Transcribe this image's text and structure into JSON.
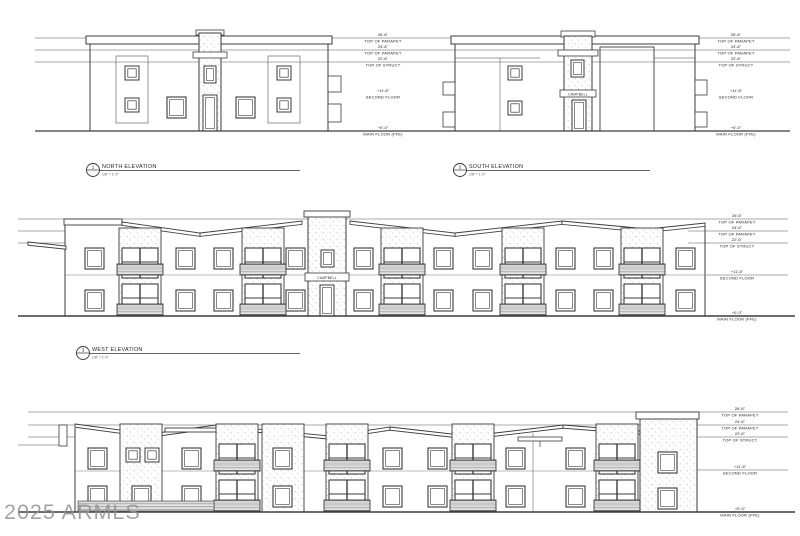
{
  "watermark": {
    "text": "2025 ARMLS"
  },
  "sign": {
    "text": "CAMPBELL"
  },
  "levels": {
    "p26": {
      "value": "26'-6\"",
      "label": "TOP OF PARAPET"
    },
    "p24": {
      "value": "24'-6\"",
      "label": "TOP OF PARAPET"
    },
    "struct": {
      "value": "22'-6\"",
      "label": "TOP OF STRUCT"
    },
    "second": {
      "value": "+11'-6\"",
      "label": "SECOND FLOOR"
    },
    "main": {
      "value": "+0'-0\"",
      "label": "MAIN FLOOR (FFE)"
    }
  },
  "elevations": {
    "north": {
      "number": "1",
      "title": "NORTH ELEVATION",
      "scale": "1/8\" = 1'-0\""
    },
    "south": {
      "number": "2",
      "title": "SOUTH ELEVATION",
      "scale": "1/8\" = 1'-0\""
    },
    "west": {
      "number": "3",
      "title": "WEST ELEVATION",
      "scale": "1/8\" = 1'-0\""
    }
  },
  "colors": {
    "line": "#3b3b3b",
    "datum": "#555555",
    "watermark": "#929292"
  }
}
